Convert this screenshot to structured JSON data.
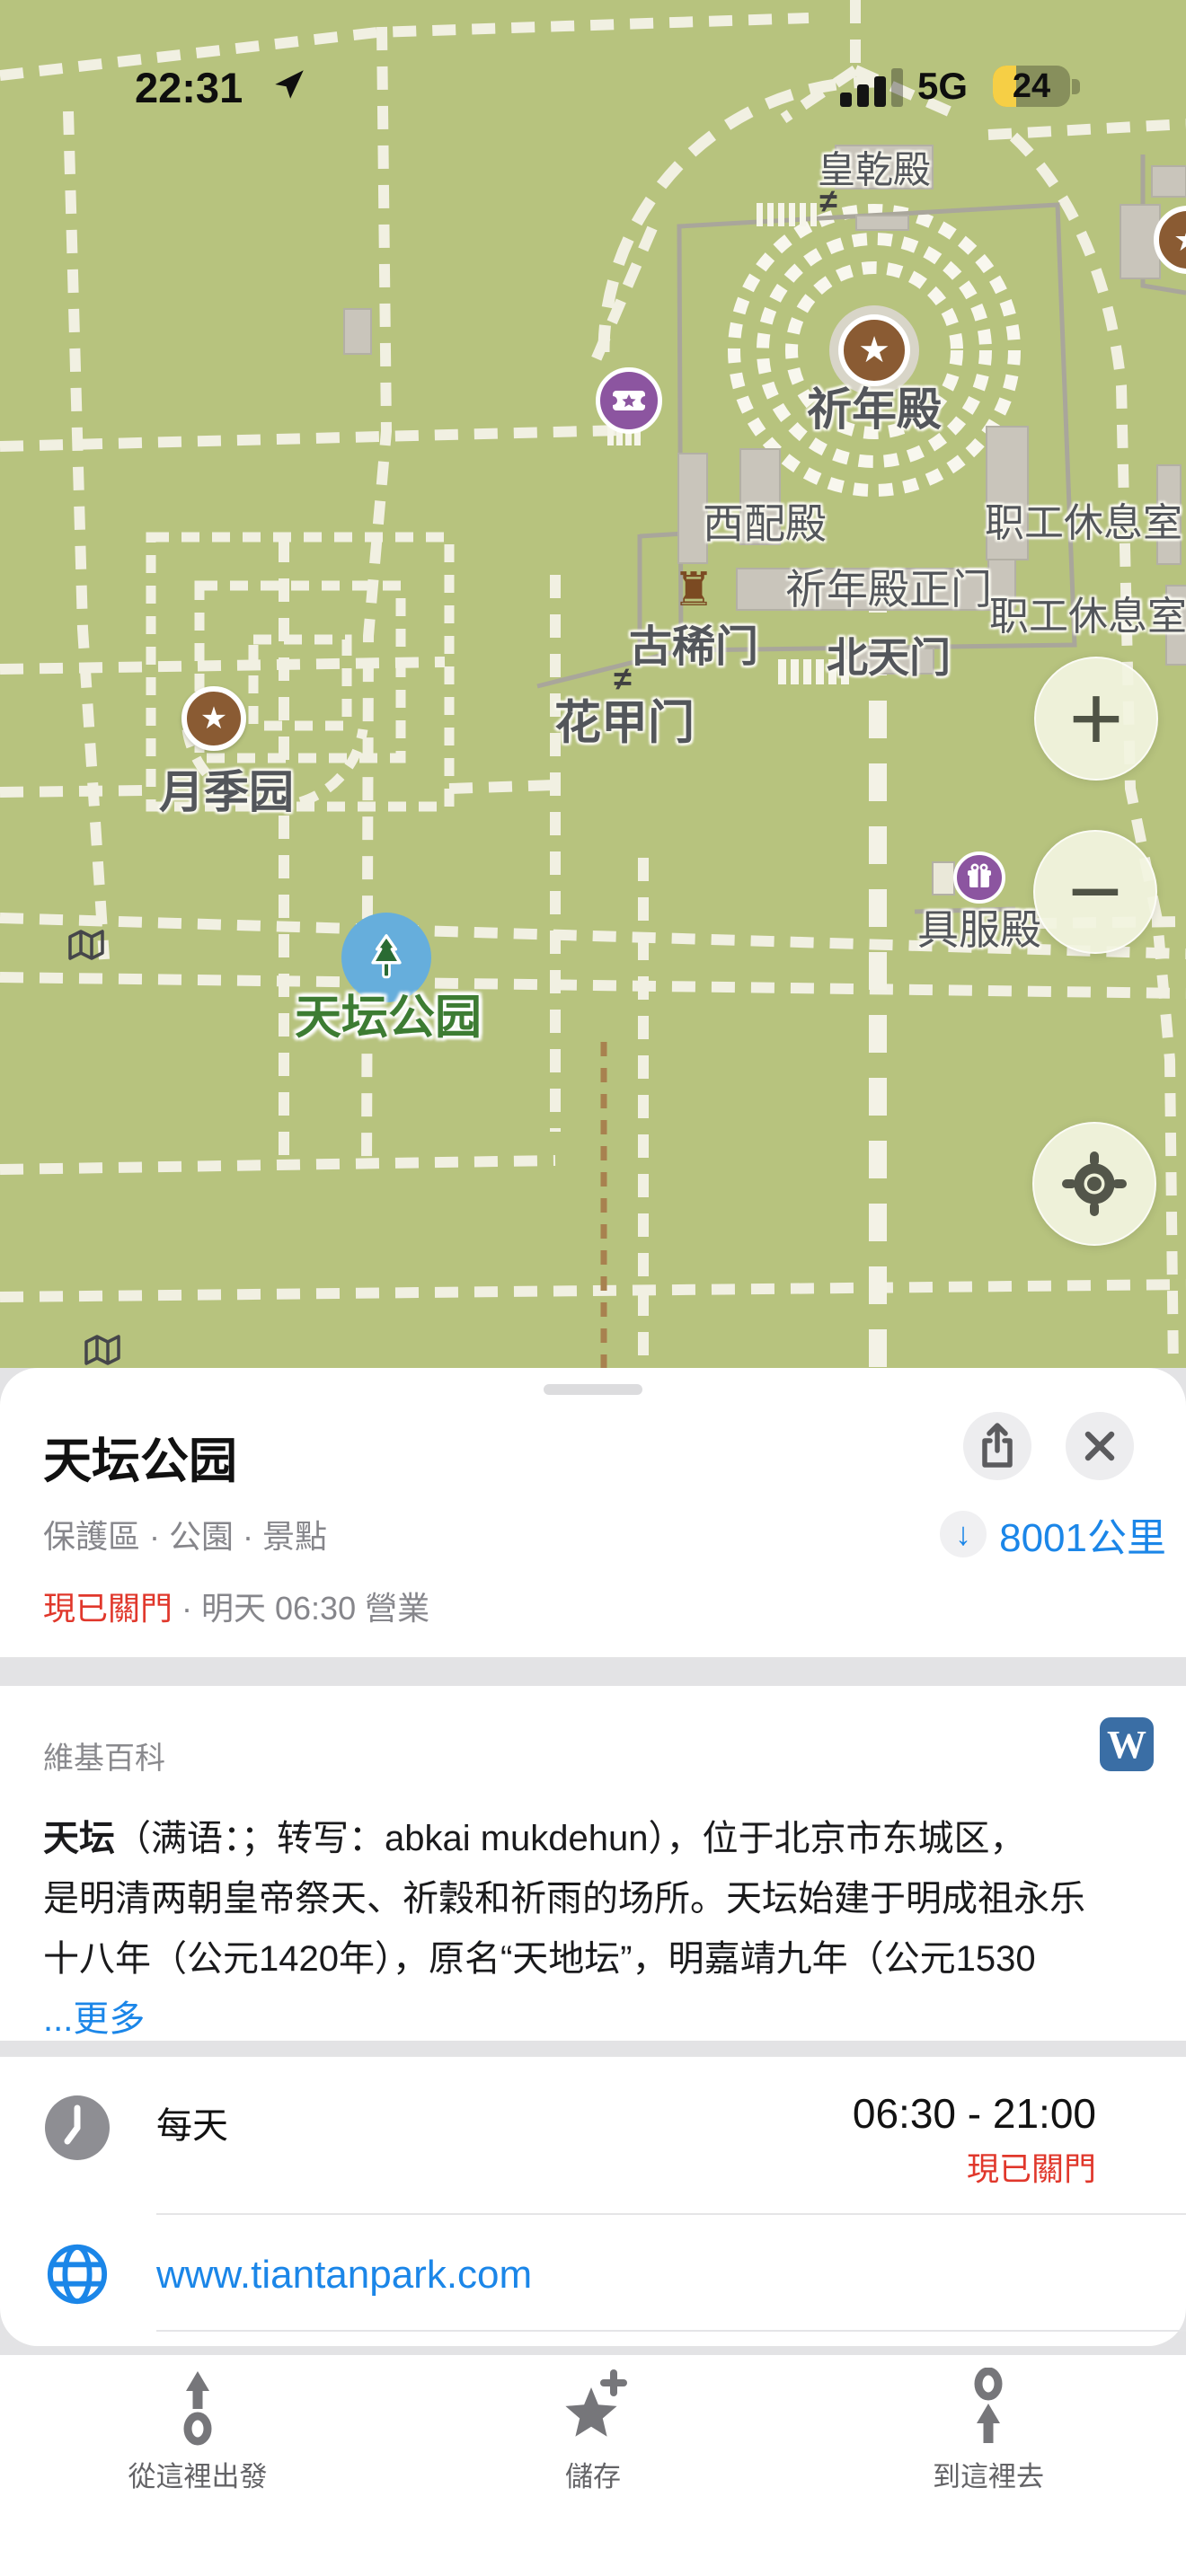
{
  "status_bar": {
    "time": "22:31",
    "network": "5G",
    "battery_level": "24"
  },
  "map": {
    "labels": [
      {
        "text": "皇乾殿"
      },
      {
        "text": "祈年殿"
      },
      {
        "text": "西配殿"
      },
      {
        "text": "职工休息室"
      },
      {
        "text": "祈年殿正门"
      },
      {
        "text": "职工休息室"
      },
      {
        "text": "北天门"
      },
      {
        "text": "古稀门"
      },
      {
        "text": "花甲门"
      },
      {
        "text": "月季园"
      },
      {
        "text": "具服殿"
      },
      {
        "text": "天坛公园"
      }
    ],
    "gate_symbol": "≠",
    "rook_symbol": "♜",
    "star_symbol": "★",
    "controls": {
      "zoom_in": "+",
      "zoom_out": "−"
    }
  },
  "sheet": {
    "title": "天坛公园",
    "categories": "保護區 · 公園 · 景點",
    "distance_arrow": "↓",
    "distance": "8001公里",
    "status_closed": "現已關門",
    "status_rest": " · 明天 06:30 營業",
    "wiki": {
      "header": "維基百科",
      "wordmark": "W",
      "lead": "天坛",
      "line1_rest": "（满语：；转写：abkai mukdehun），位于北京市东城区，",
      "line2": "是明清两朝皇帝祭天、祈穀和祈雨的场所。天坛始建于明成祖永乐",
      "line3": "十八年（公元1420年），原名“天地坛”，明嘉靖九年（公元1530",
      "more": "...更多"
    },
    "hours": {
      "label": "每天",
      "time": "06:30 - 21:00",
      "status": "現已關門"
    },
    "website": "www.tiantanpark.com"
  },
  "tabbar": {
    "items": [
      {
        "label": "從這裡出發"
      },
      {
        "label": "儲存"
      },
      {
        "label": "到這裡去"
      }
    ]
  },
  "colors": {
    "accent_blue": "#1B86E8",
    "closed_red": "#E0372B",
    "wikipedia_blue": "#3A6EA5",
    "battery_yellow": "#F6CF45",
    "park_green": "#3D7C33",
    "map_background": "#B7C37E"
  }
}
